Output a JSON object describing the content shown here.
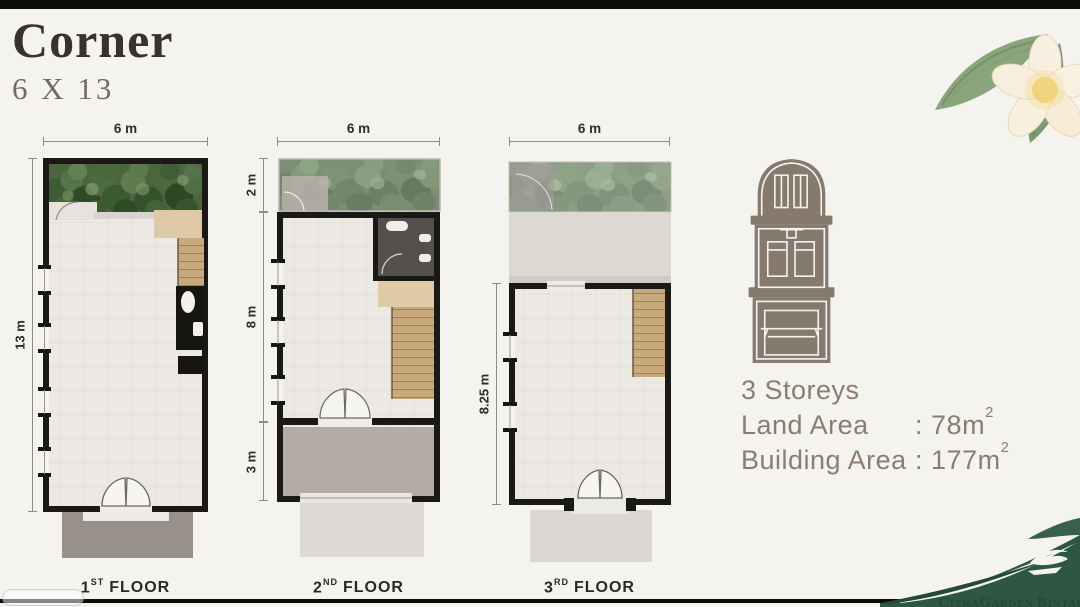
{
  "title": "Corner",
  "subtitle": "6 X 13",
  "plans": [
    {
      "name": "1st-floor",
      "top_dim": "6 m",
      "side_dims": [
        "13 m"
      ],
      "label": {
        "num": "1",
        "sup": "ST",
        "word": "FLOOR"
      }
    },
    {
      "name": "2nd-floor",
      "top_dim": "6 m",
      "side_dims": [
        "2 m",
        "8 m",
        "3 m"
      ],
      "label": {
        "num": "2",
        "sup": "ND",
        "word": "FLOOR"
      }
    },
    {
      "name": "3rd-floor",
      "top_dim": "6 m",
      "side_dims": [
        "8.25 m"
      ],
      "label": {
        "num": "3",
        "sup": "RD",
        "word": "FLOOR"
      }
    }
  ],
  "specs": {
    "storeys": "3 Storeys",
    "rows": [
      {
        "label": "Land Area",
        "sep": ":",
        "value": "78m",
        "sup": "2"
      },
      {
        "label": "Building Area",
        "sep": ":",
        "value": "177m",
        "sup": "2"
      }
    ]
  },
  "brand": {
    "wordmark": "CitraGarden Bintaro"
  },
  "icons": [
    "building-elevation-icon",
    "frangipani-flower-illustration",
    "leaf-swoosh-illustration",
    "bird-logo-icon"
  ],
  "colors": {
    "background": "#f5f3f0",
    "wall_black": "#1b1916",
    "accent_taupe": "#8c7d70",
    "title_text": "#38322c",
    "brand_green": "#2d5742",
    "wordmark_green": "#1c4a36",
    "wood_stairs": "#c9aa7d",
    "floor_tile": "#ece8e3",
    "driveway_gray": "#97918a"
  }
}
